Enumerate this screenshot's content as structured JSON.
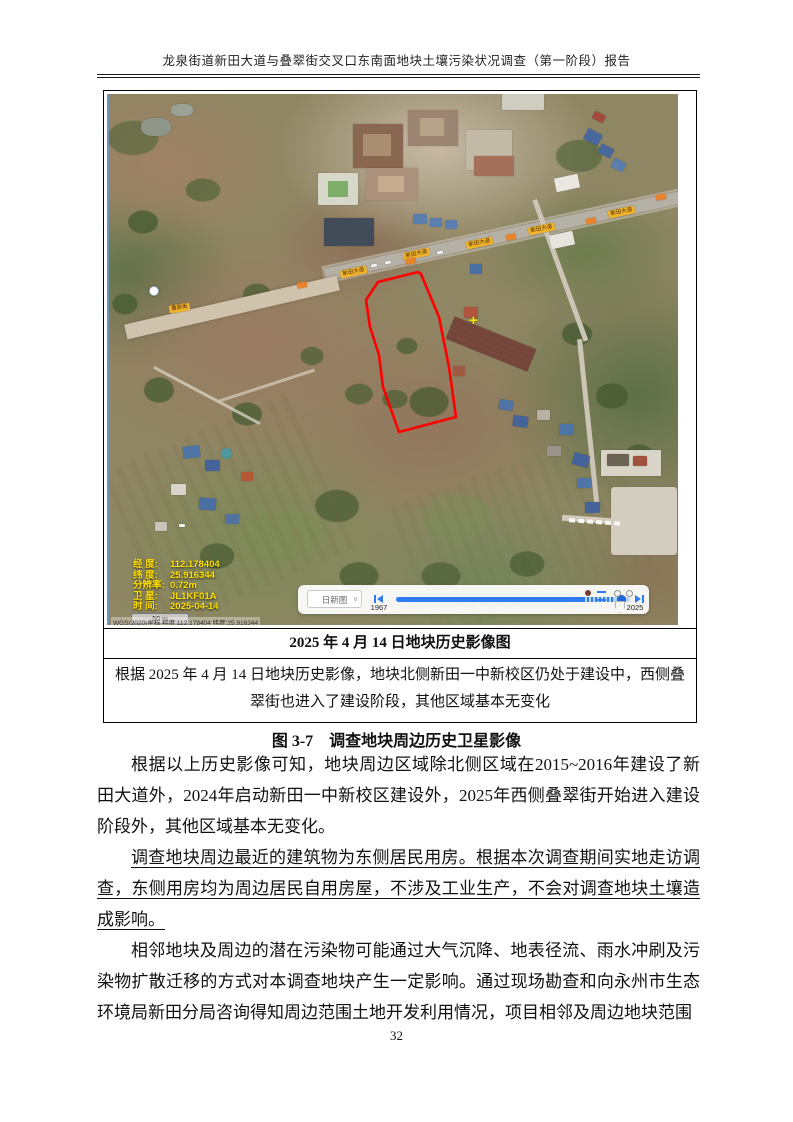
{
  "header": {
    "title": "龙泉街道新田大道与叠翠街交叉口东南面地块土壤污染状况调查（第一阶段）报告"
  },
  "figure": {
    "image_title": "2025 年 4 月 14 日地块历史影像图",
    "image_note": "根据 2025 年 4 月 14 日地块历史影像，地块北侧新田一中新校区仍处于建设中，西侧叠翠街也进入了建设阶段，其他区域基本无变化",
    "caption": "图 3-7　调查地块周边历史卫星影像"
  },
  "map": {
    "overlay": [
      {
        "label": "经 度:",
        "value": "112.178404"
      },
      {
        "label": "纬 度:",
        "value": "25.916344"
      },
      {
        "label": "分辨率:",
        "value": "0.72m"
      },
      {
        "label": "卫 星:",
        "value": "JL1KF01A"
      },
      {
        "label": "时 间:",
        "value": "2025-04-14"
      }
    ],
    "scale_label": "50 m",
    "status_text": "WGS(2020)坐标  经度:112.178404  纬度:25.916344",
    "road_label_main": "新田大道",
    "road_label_west": "叠翠街",
    "marker": "+",
    "timeline": {
      "layer": "日新图",
      "start_year": "1967",
      "end_year": "2025"
    },
    "colors": {
      "boundary": "#ff0000",
      "overlay_text": "#ffdf00",
      "timeline_blue": "#2e7bf3",
      "road_badge": "#f2b32e"
    }
  },
  "paragraphs": {
    "p1": "根据以上历史影像可知，地块周边区域除北侧区域在2015~2016年建设了新田大道外，2024年启动新田一中新校区建设外，2025年西侧叠翠街开始进入建设阶段外，其他区域基本无变化。",
    "p2": "调查地块周边最近的建筑物为东侧居民用房。根据本次调查期间实地走访调查，东侧用房均为周边居民自用房屋，不涉及工业生产，不会对调查地块土壤造成影响。",
    "p3": "相邻地块及周边的潜在污染物可能通过大气沉降、地表径流、雨水冲刷及污染物扩散迁移的方式对本调查地块产生一定影响。通过现场勘查和向永州市生态环境局新田分局咨询得知周边范围土地开发利用情况，项目相邻及周边地块范围"
  },
  "footer": {
    "page_number": "32"
  }
}
